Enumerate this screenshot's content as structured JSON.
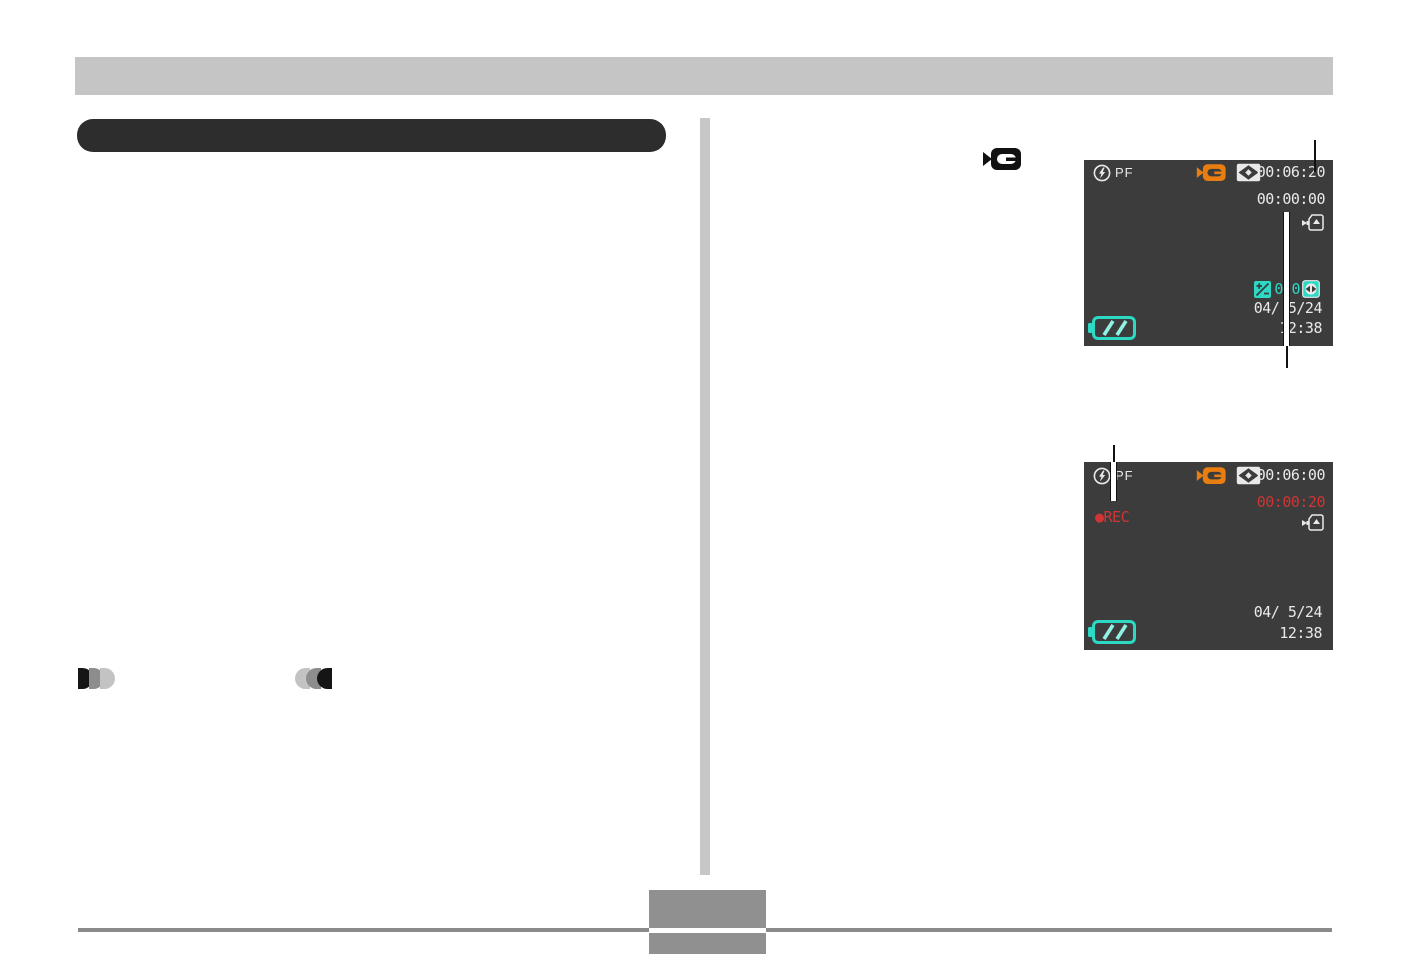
{
  "page": {
    "kind": "camera-manual-page",
    "header_bar_text": "",
    "section_heading_text": "",
    "page_number_text": ""
  },
  "screens": [
    {
      "name": "movie-standby",
      "flash_mode": "PF",
      "remaining_time": "00:06:20",
      "elapsed_time": "00:00:00",
      "ev_value": "0.0",
      "date": "04/ 5/24",
      "time": "12:38"
    },
    {
      "name": "movie-recording",
      "flash_mode": "PF",
      "remaining_time": "00:06:00",
      "elapsed_time": "00:00:20",
      "rec_indicator": "●REC",
      "date": "04/ 5/24",
      "time": "12:38"
    }
  ],
  "icons": {
    "movie_mode": "camcorder",
    "flash": "circled-lightning",
    "metering": "multi-pattern-metering",
    "save": "card-save-arrow",
    "ev_shift": "plus-minus-box",
    "contrast": "circle-left-right-arrows",
    "battery": "battery-full",
    "fade_in": "three-discs-right",
    "fade_out": "three-discs-left"
  },
  "colors": {
    "screen_bg": "#3c3c3c",
    "screen_text": "#e9e9e9",
    "accent_orange": "#e87d10",
    "accent_teal": "#2bd9c4",
    "rec_red": "#d03434",
    "header_gray": "#c5c5c5",
    "heading_dark": "#2d2d2d",
    "footer_gray": "#909090"
  }
}
